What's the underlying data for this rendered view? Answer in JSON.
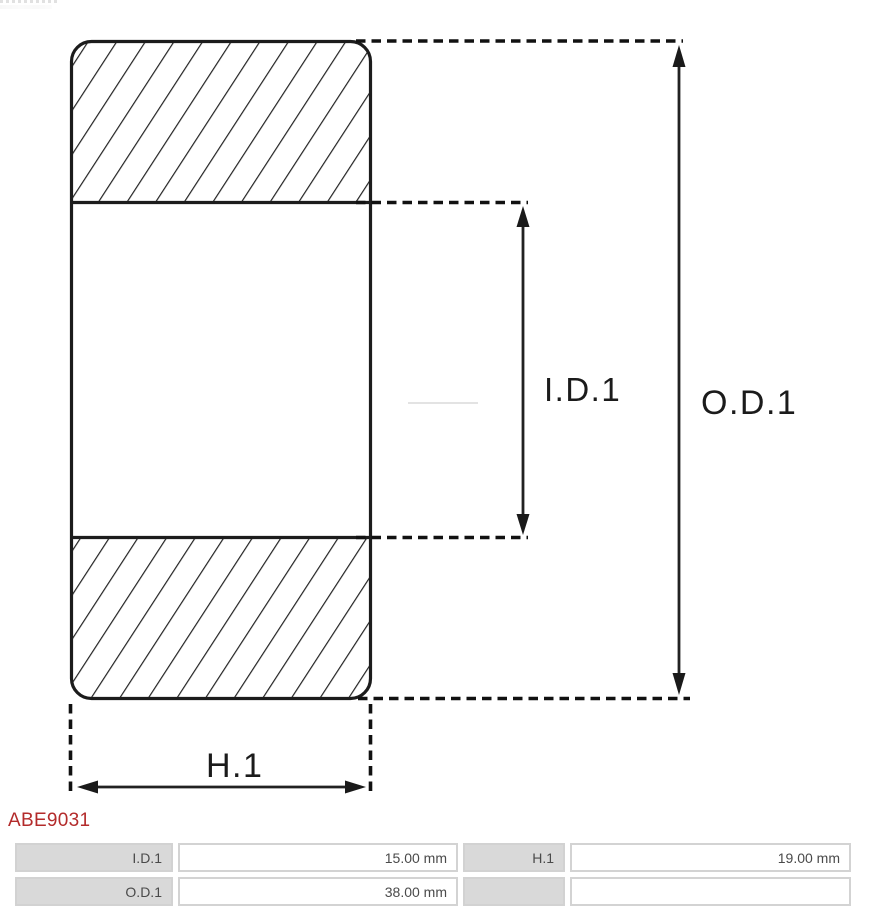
{
  "part": {
    "number": "ABE9031"
  },
  "diagram": {
    "type": "bearing-cross-section-drawing",
    "dimension_labels": {
      "inner_diameter": "I.D.1",
      "outer_diameter": "O.D.1",
      "height": "H.1"
    }
  },
  "spec_table": {
    "rows": [
      {
        "cells": [
          {
            "text": "I.D.1"
          },
          {
            "text": "15.00 mm"
          },
          {
            "text": "H.1"
          },
          {
            "text": "19.00 mm"
          }
        ]
      },
      {
        "cells": [
          {
            "text": "O.D.1"
          },
          {
            "text": "38.00 mm"
          },
          {
            "text": ""
          },
          {
            "text": ""
          }
        ]
      }
    ]
  },
  "colors": {
    "accent_red": "#b32b2b",
    "table_label_bg": "#d9d9d9",
    "table_border": "#d3d3d3",
    "drawing_line": "#1c1c1c"
  }
}
